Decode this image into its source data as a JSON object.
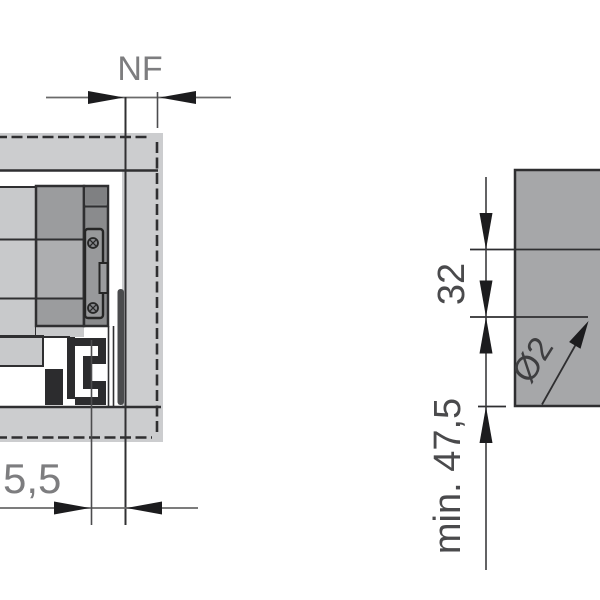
{
  "drawing": {
    "left_view": {
      "nf_label": "NF",
      "front_gap_label": "5,5"
    },
    "right_view": {
      "row_spacing_label": "32",
      "min_height_label": "min. 47,5",
      "hole_diameter_label": "Ø2"
    },
    "colors": {
      "line_dark": "#2f2f31",
      "panel_light_gray": "#cccdcf",
      "panel_mid_gray": "#a6a7a9",
      "profile_gray": "#9b9c9e",
      "profile_dark_gray": "#8a8b8d",
      "hardware_dark": "#2c2c2e",
      "dim_line_gray": "#6a6a6a",
      "dim_text_gray": "#7d7d7f",
      "dim_text_dark": "#4a4a4c",
      "arrow_black": "#1c1c1e"
    }
  }
}
